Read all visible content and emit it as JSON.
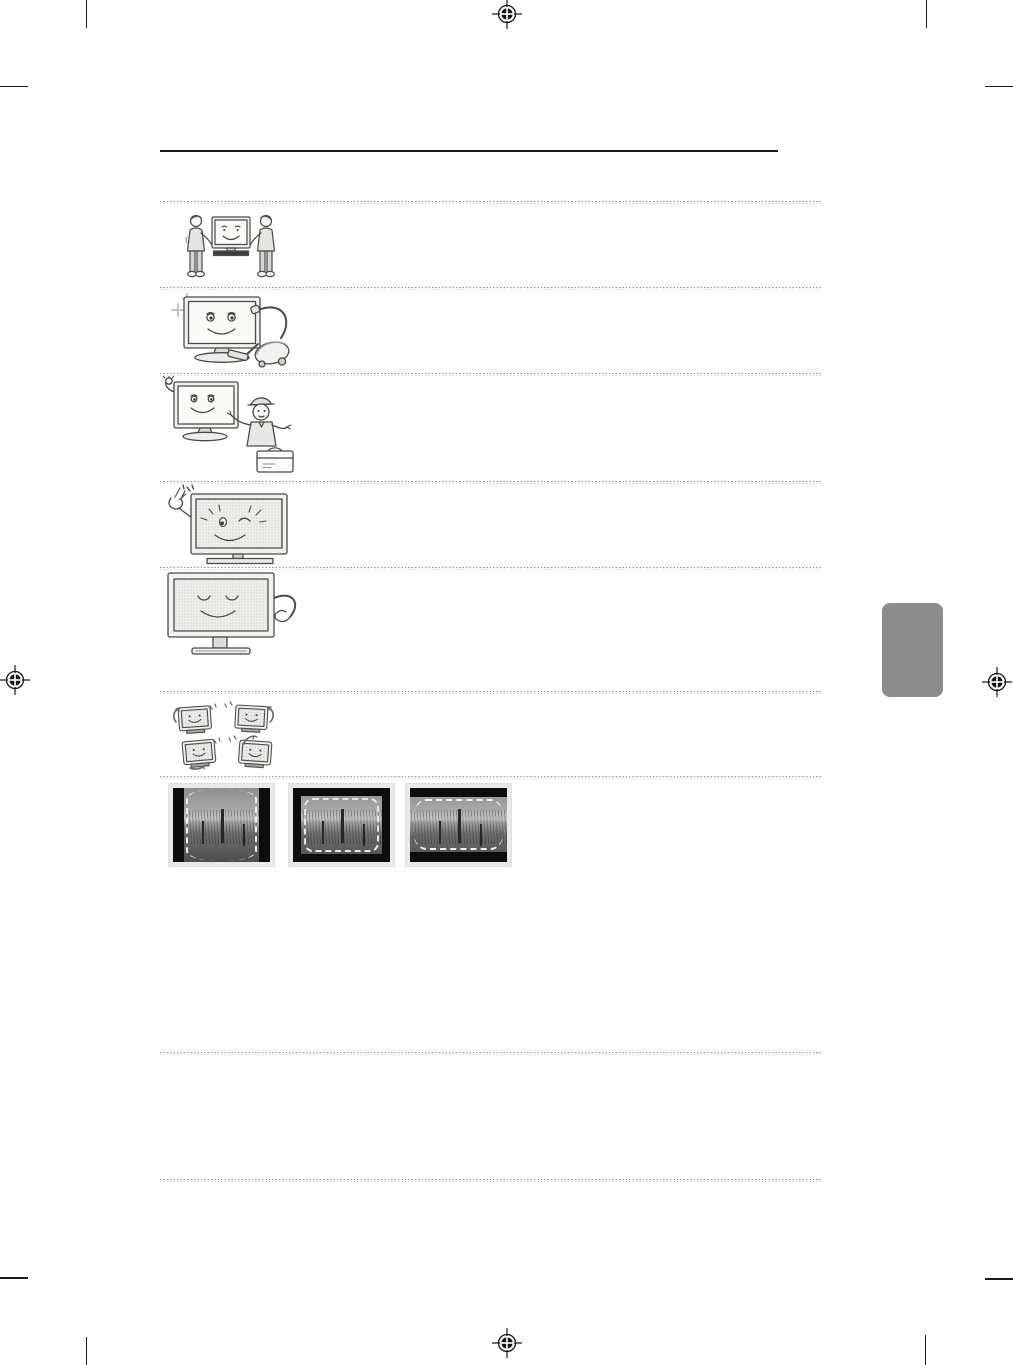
{
  "document": {
    "kind": "tv-user-manual-printed-page",
    "page_background": "#ffffff",
    "visible_text": ""
  },
  "colors": {
    "crop_mark": "#1a1a1a",
    "solid_rule": "#1a1a1a",
    "dotted_rule_dark": "#8f8f8f",
    "dotted_rule_light": "#d9d9d9",
    "side_tab": "#8c8c8c",
    "line_art_stroke": "#4a4a4a",
    "line_art_fill": "#f2f2ee",
    "screen_halftone": "#c9c9c9",
    "photo_mat": "#e9e9e9",
    "photo_black_bar": "#0c0c0c",
    "photo_dash": "#ffffff"
  },
  "print_marks": {
    "registration_marks": [
      {
        "name": "registration-top-center"
      },
      {
        "name": "registration-left-middle"
      },
      {
        "name": "registration-right-middle"
      },
      {
        "name": "registration-bottom-center"
      }
    ],
    "corner_crop_mark_count": 8
  },
  "sections": [
    {
      "illustration": "two-people-carrying-tv-illustration"
    },
    {
      "illustration": "tv-cleaned-with-vacuum-illustration"
    },
    {
      "illustration": "tv-with-service-technician-illustration"
    },
    {
      "illustration": "winking-tv-with-snapping-hand-illustration"
    },
    {
      "illustration": "smiling-tv-patted-by-hand-illustration"
    },
    {
      "illustration": "four-tvs-rotation-arrows-illustration"
    },
    {
      "illustration": "screen-burn-in-example-photos"
    }
  ],
  "burn_in_examples": [
    {
      "name": "pillarbox-image-black-side-bars"
    },
    {
      "name": "windowbox-image-black-border-all-sides"
    },
    {
      "name": "letterbox-image-black-top-bottom-bars"
    }
  ]
}
